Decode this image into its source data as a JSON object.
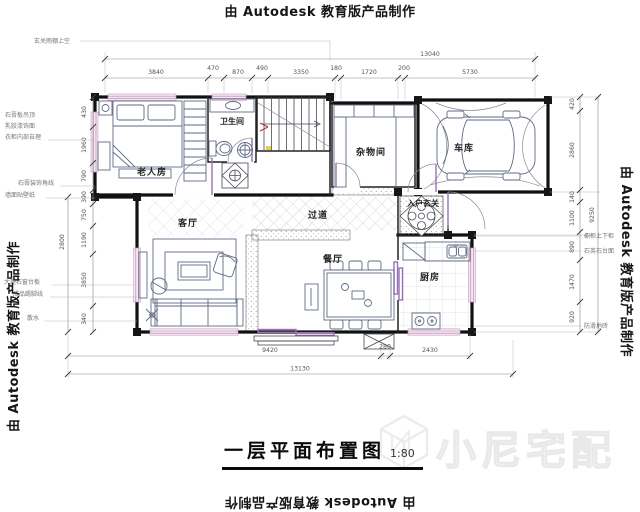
{
  "watermarks": {
    "autodesk_top": "由 Autodesk 教育版产品制作",
    "autodesk_left": "由 Autodesk 教育版产品制作",
    "autodesk_right": "由 Autodesk 教育版产品制作",
    "autodesk_bottom": "由 Autodesk 教育版产品制作",
    "brand": "小尼宅配"
  },
  "title": {
    "text": "一层平面布置图",
    "scale": "1:80"
  },
  "rooms": {
    "elder_bedroom": "老人房",
    "bathroom": "卫生间",
    "storage": "杂物间",
    "garage": "车库",
    "hallway": "过道",
    "foyer": "入户玄关",
    "living": "客厅",
    "dining": "餐厅",
    "kitchen": "厨房"
  },
  "dimensions": {
    "top": {
      "total": "13040",
      "segments": [
        "3840",
        "470",
        "870",
        "490",
        "3350",
        "180",
        "1720",
        "200",
        "5730"
      ]
    },
    "bottom": {
      "total": "13130",
      "segments": [
        "9420",
        "280",
        "2430"
      ]
    },
    "left": {
      "overall": "2800",
      "segments": [
        "430",
        "1960",
        "790",
        "390",
        "750",
        "1190",
        "3850",
        "340"
      ]
    },
    "right": {
      "overall": "9250",
      "segments": [
        "420",
        "2860",
        "140",
        "1100",
        "890",
        "1470",
        "920"
      ]
    }
  },
  "annotations": {
    "top_note": "玄关雨棚上空",
    "left": [
      "石膏板吊顶",
      "乳胶漆饰面",
      "衣柜内部自理",
      "石膏装饰角线",
      "墙面贴壁纸",
      "大理石窗台板",
      "成品踢脚线",
      "散水"
    ],
    "right": [
      "橱柜上下柜",
      "石英石台面",
      "防滑地砖"
    ]
  },
  "colors": {
    "wall": "#111111",
    "furniture": "#5e6a84",
    "window_fill": "#f7e6f3",
    "door_accent": "#9a6fb8",
    "section_red": "#c43232",
    "brand_watermark": "#e9e9e9"
  }
}
